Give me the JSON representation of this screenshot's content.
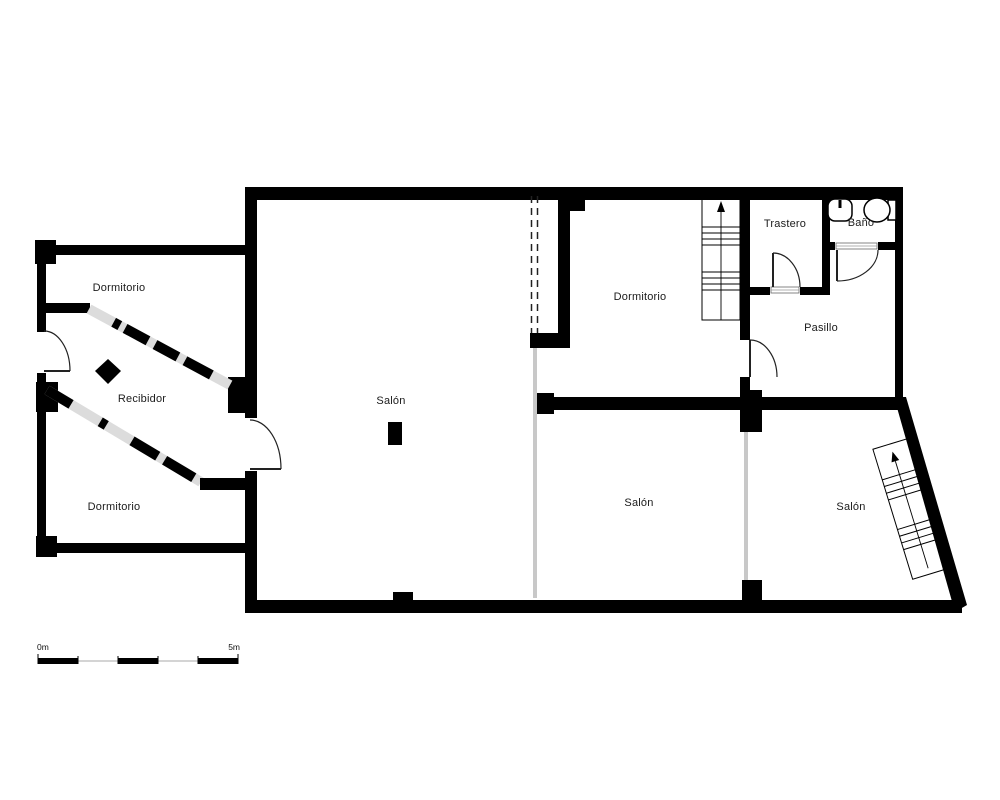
{
  "plan_title": "floor-plan",
  "rooms": [
    {
      "id": "dormitorio-nw",
      "label": "Dormitorio"
    },
    {
      "id": "recibidor",
      "label": "Recibidor"
    },
    {
      "id": "dormitorio-sw",
      "label": "Dormitorio"
    },
    {
      "id": "salon-central",
      "label": "Salón"
    },
    {
      "id": "dormitorio-middle",
      "label": "Dormitorio"
    },
    {
      "id": "trastero",
      "label": "Trastero"
    },
    {
      "id": "bano",
      "label": "Baño"
    },
    {
      "id": "pasillo",
      "label": "Pasillo"
    },
    {
      "id": "salon-middle",
      "label": "Salón"
    },
    {
      "id": "salon-right",
      "label": "Salón"
    }
  ],
  "scale_bar": {
    "start_label": "0m",
    "end_label": "5m"
  },
  "symbols": {
    "staircases": [
      {
        "location": "dormitorio-middle",
        "direction": "up"
      },
      {
        "location": "salon-right",
        "direction": "up"
      }
    ],
    "fixtures": [
      "sink",
      "toilet"
    ],
    "markers": [
      "diamond",
      "column"
    ]
  },
  "colors": {
    "wall": "#000000",
    "glazing": "#dcdcdc",
    "open-divider": "#c8c8c8",
    "background": "#ffffff"
  }
}
